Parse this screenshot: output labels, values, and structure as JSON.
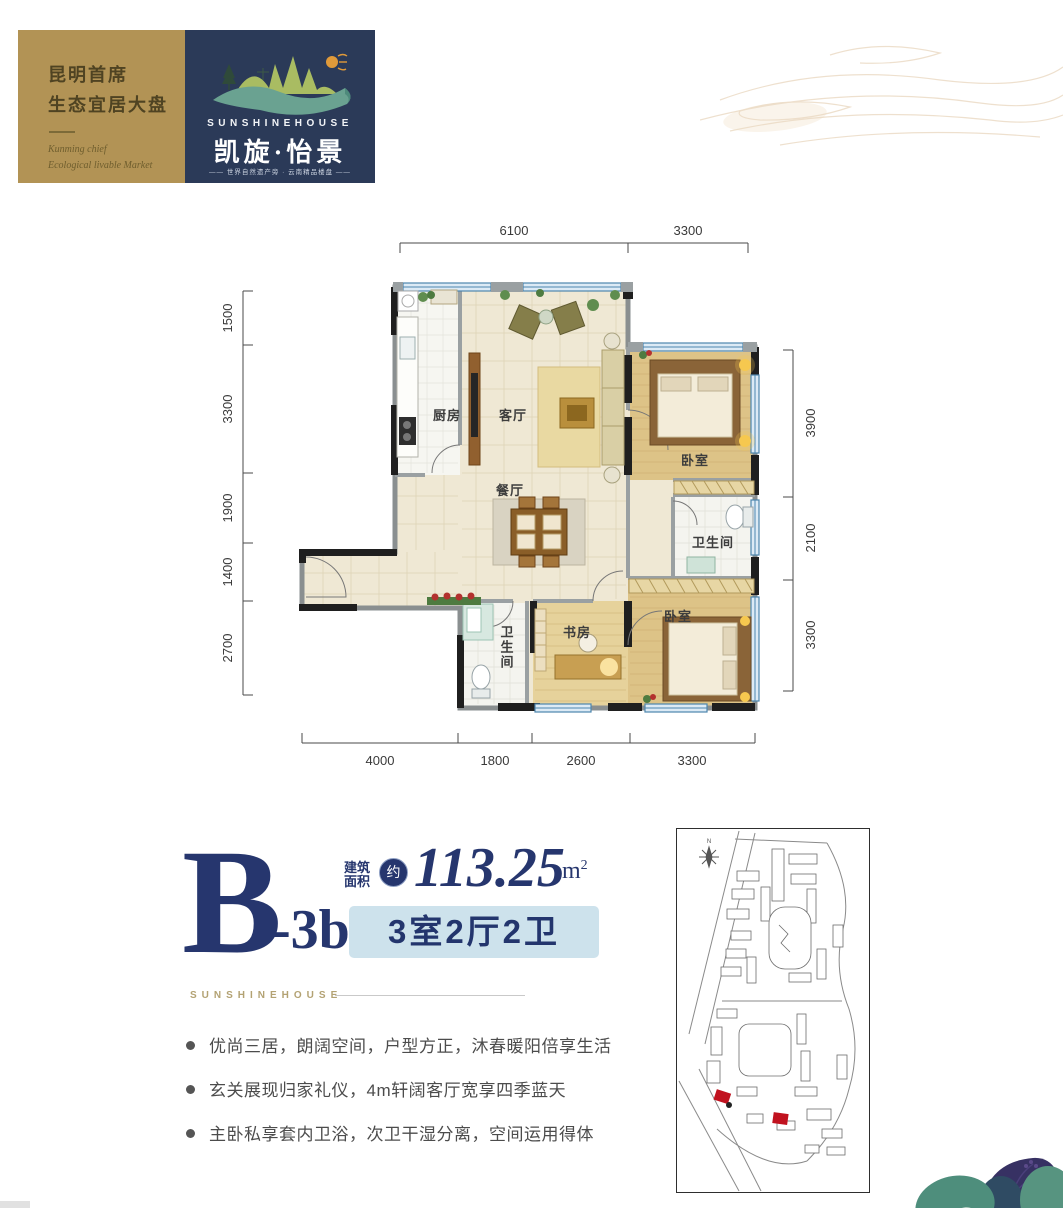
{
  "header": {
    "gold_card": {
      "line1": "昆明首席",
      "line2": "生态宜居大盘",
      "script_line1": "Kunming chief",
      "script_line2": "Ecological livable Market",
      "bg_color": "#b29355"
    },
    "logo_card": {
      "brand_en": "SUNSHINEHOUSE",
      "brand_cn": "凯旋·怡景",
      "tagline": "—— 世界自然遗产旁 · 云南精品楼盘 ——",
      "bg_color": "#2b3a58"
    }
  },
  "floor_plan": {
    "dimensions": {
      "top": [
        "6100",
        "3300"
      ],
      "left": [
        "1500",
        "3300",
        "1900",
        "1400",
        "2700"
      ],
      "right": [
        "3900",
        "2100",
        "3300"
      ],
      "bottom": [
        "4000",
        "1800",
        "2600",
        "3300"
      ]
    },
    "rooms": {
      "kitchen": "厨房",
      "living": "客厅",
      "dining": "餐厅",
      "bedroom_master": "卧室",
      "bathroom_master": "卫生间",
      "bedroom_second": "卧室",
      "study": "书房",
      "bathroom_guest": "卫生间"
    },
    "window_color": "#4d86ae",
    "wall_color": "#1f1f1f"
  },
  "unit": {
    "letter": "B",
    "variant": "-3b",
    "area_label_line1": "建筑",
    "area_label_line2": "面积",
    "approx": "约",
    "value": "113.25",
    "unit_m": "m",
    "unit_exp": "2",
    "layout": "3室2厅2卫",
    "brand_small": "SUNSHINEHOUSE",
    "accent_navy": "#26366e",
    "pill_bg": "#cde2ec"
  },
  "features": [
    "优尚三居，朗阔空间，户型方正，沐春暖阳倍享生活",
    "玄关展现归家礼仪，4m轩阔客厅宽享四季蓝天",
    "主卧私享套内卫浴，次卫干湿分离，空间运用得体"
  ],
  "site_plan": {
    "compass": "N",
    "highlight_color": "#c1121f"
  }
}
